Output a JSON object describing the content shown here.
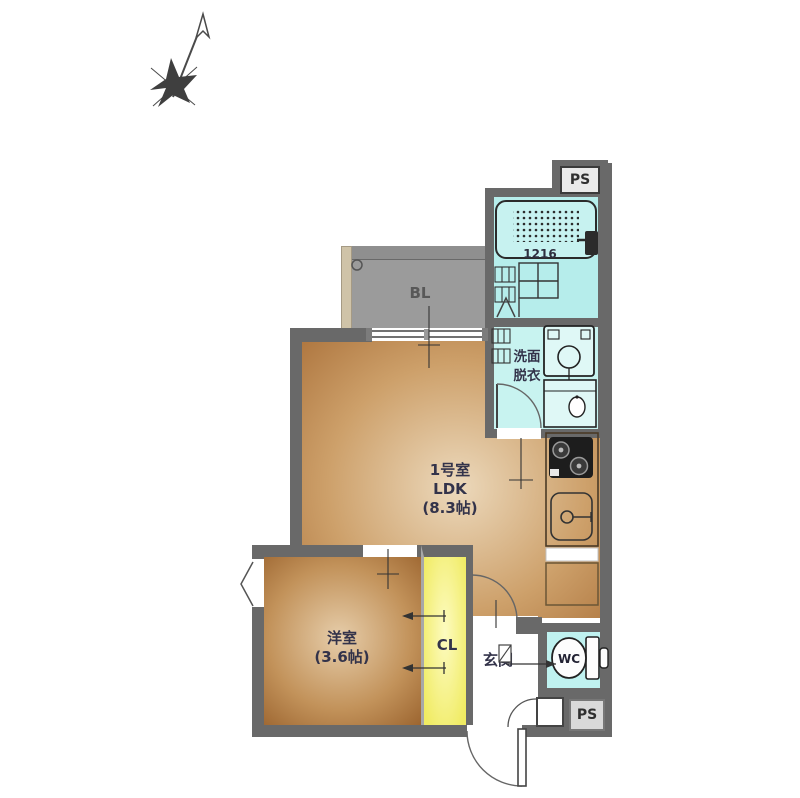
{
  "plan_title": "floor plan",
  "colors": {
    "wall": "#696969",
    "balcony_floor": "#9b9b9b",
    "balcony_top": "#8f8f8f",
    "partition_beige": "#cfc3a8",
    "water_cyan": "#b6edeb",
    "water_cyan_light": "#c8f3f0",
    "floor_brown_light": "#ecd9bc",
    "floor_brown_mid": "#cda06a",
    "floor_brown_dark": "#a96f38",
    "closet_yellow_light": "#fdfbc0",
    "closet_yellow": "#f0eb62",
    "text": "#33334a"
  },
  "rooms": {
    "ldk": {
      "room_no": "1号室",
      "type": "LDK",
      "size": "(8.3帖)"
    },
    "western_room": {
      "label": "洋室",
      "size": "(3.6帖)"
    },
    "balcony": {
      "label": "BL"
    },
    "closet": {
      "label": "CL"
    },
    "entrance": {
      "label": "玄関"
    },
    "washroom": {
      "label_line1": "洗面",
      "label_line2": "脱衣"
    },
    "toilet": {
      "label": "WC"
    },
    "bathroom": {
      "tub_size": "1216"
    },
    "pipe_space_top": {
      "label": "PS"
    },
    "pipe_space_bottom": {
      "label": "PS"
    }
  }
}
